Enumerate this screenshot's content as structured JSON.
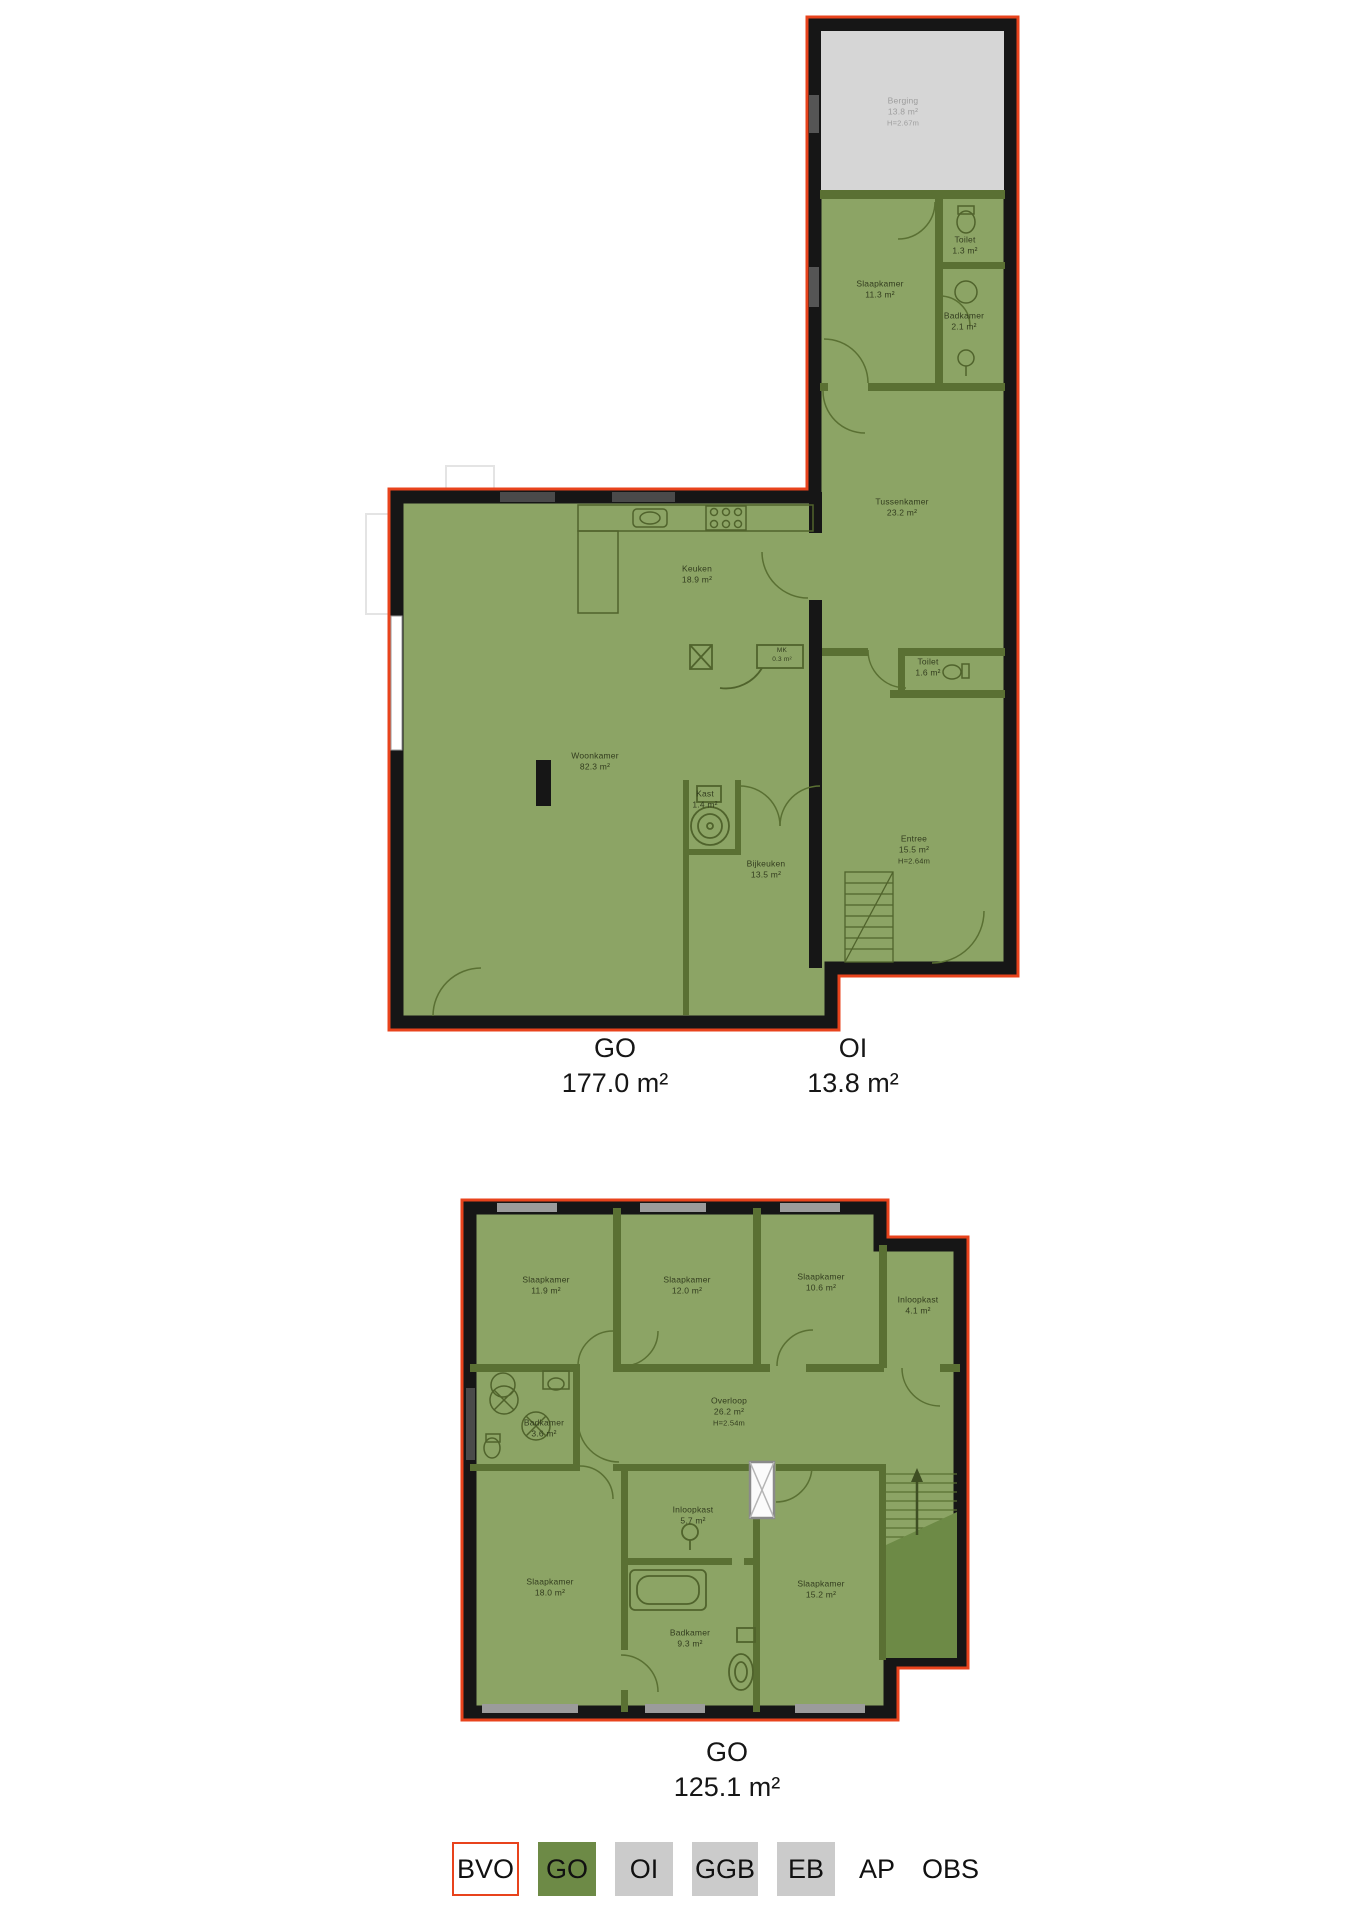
{
  "document": {
    "type": "floorplan",
    "background": "#ffffff"
  },
  "colors": {
    "outline_red": "#e8431c",
    "wall_black": "#161616",
    "room_green": "#8ca465",
    "partition_green": "#5a7033",
    "dark_green": "#6d8a46",
    "storage_grey": "#d6d6d6",
    "legend_grey": "#cbcbcb",
    "room_label_text": "#333d1f",
    "area_label_text": "#161616"
  },
  "floor1": {
    "rooms": [
      {
        "name": "Berging",
        "area": "13.8 m²",
        "height": "H=2.67m"
      },
      {
        "name": "Slaapkamer",
        "area": "11.3 m²"
      },
      {
        "name": "Toilet",
        "area": "1.3 m²"
      },
      {
        "name": "Badkamer",
        "area": "2.1 m²"
      },
      {
        "name": "Tussenkamer",
        "area": "23.2 m²"
      },
      {
        "name": "Keuken",
        "area": "18.9 m²"
      },
      {
        "name": "MK",
        "area": "0.3 m²"
      },
      {
        "name": "Toilet",
        "area": "1.6 m²"
      },
      {
        "name": "Woonkamer",
        "area": "82.3 m²"
      },
      {
        "name": "Kast",
        "area": "1.4 m²"
      },
      {
        "name": "Bijkeuken",
        "area": "13.5 m²"
      },
      {
        "name": "Entree",
        "area": "15.5 m²",
        "height": "H=2.64m"
      }
    ],
    "area_labels": [
      {
        "code": "GO",
        "value": "177.0 m²"
      },
      {
        "code": "OI",
        "value": "13.8 m²"
      }
    ]
  },
  "floor2": {
    "rooms": [
      {
        "name": "Slaapkamer",
        "area": "11.9 m²"
      },
      {
        "name": "Slaapkamer",
        "area": "12.0 m²"
      },
      {
        "name": "Slaapkamer",
        "area": "10.6 m²"
      },
      {
        "name": "Inloopkast",
        "area": "4.1 m²"
      },
      {
        "name": "Overloop",
        "area": "26.2 m²",
        "height": "H=2.54m"
      },
      {
        "name": "Badkamer",
        "area": "3.6 m²"
      },
      {
        "name": "Inloopkast",
        "area": "5.7 m²"
      },
      {
        "name": "Slaapkamer",
        "area": "18.0 m²"
      },
      {
        "name": "Badkamer",
        "area": "9.3 m²"
      },
      {
        "name": "Slaapkamer",
        "area": "15.2 m²"
      }
    ],
    "area_labels": [
      {
        "code": "GO",
        "value": "125.1 m²"
      }
    ]
  },
  "legend": {
    "items": [
      {
        "label": "BVO",
        "swatch": "bvo-outline"
      },
      {
        "label": "GO",
        "swatch": "green"
      },
      {
        "label": "OI",
        "swatch": "grey"
      },
      {
        "label": "GGB",
        "swatch": "grey"
      },
      {
        "label": "EB",
        "swatch": "grey"
      },
      {
        "label": "AP",
        "swatch": "none"
      },
      {
        "label": "OBS",
        "swatch": "none"
      }
    ]
  }
}
